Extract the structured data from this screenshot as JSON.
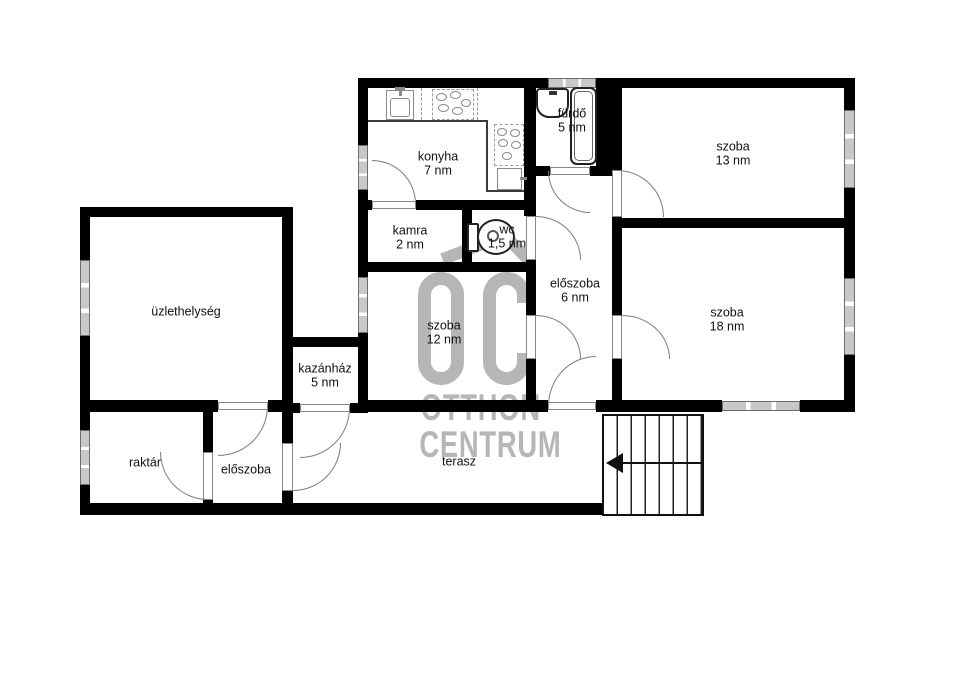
{
  "watermark": {
    "logo": "OC",
    "line1": "OTTHON",
    "line2": "CENTRUM"
  },
  "rooms": {
    "konyha": {
      "name": "konyha",
      "area": "7 nm"
    },
    "furdo": {
      "name": "fürdő",
      "area": "5 nm"
    },
    "szoba13": {
      "name": "szoba",
      "area": "13 nm"
    },
    "kamra": {
      "name": "kamra",
      "area": "2 nm"
    },
    "wc": {
      "name": "wc",
      "area": "1,5 nm"
    },
    "eloszoba_felso": {
      "name": "előszoba",
      "area": "6 nm"
    },
    "szoba18": {
      "name": "szoba",
      "area": "18 nm"
    },
    "uzlethelyseg": {
      "name": "üzlethelység",
      "area": ""
    },
    "szoba12": {
      "name": "szoba",
      "area": "12 nm"
    },
    "kazanhaz": {
      "name": "kazánház",
      "area": "5 nm"
    },
    "raktar": {
      "name": "raktár",
      "area": ""
    },
    "eloszoba_also": {
      "name": "előszoba",
      "area": ""
    },
    "terasz": {
      "name": "terasz",
      "area": ""
    }
  },
  "stairs": {
    "steps": 7,
    "direction": "left"
  },
  "fixtures": [
    "washbasin-icon",
    "bathtub-icon",
    "toilet-icon",
    "kitchen-sink-icon",
    "stove-icon",
    "stairs-direction-arrow-icon"
  ],
  "colors": {
    "wall": "#000000",
    "window_fill": "#c8c8c8",
    "door_arc": "#7d7d7d",
    "watermark": "#b6b6b6",
    "label_text": "#111111",
    "background": "#ffffff"
  }
}
